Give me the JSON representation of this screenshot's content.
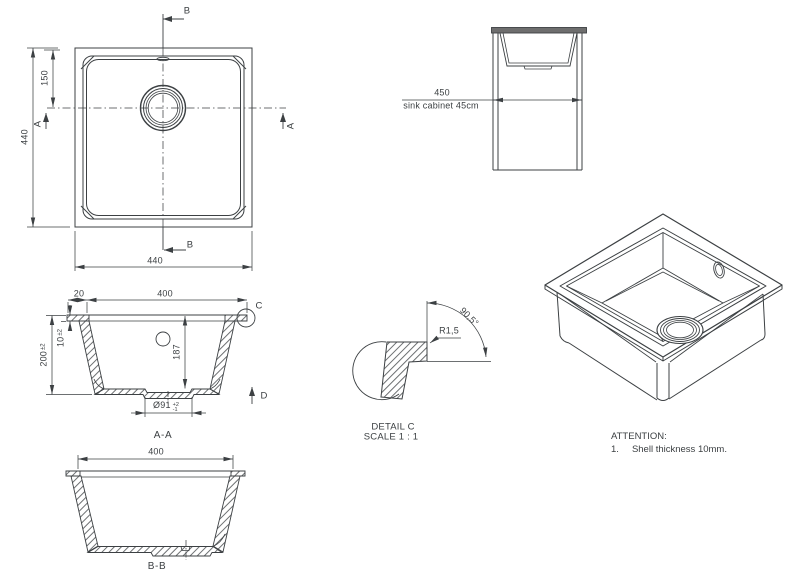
{
  "colors": {
    "line": "#3c4043",
    "text": "#3c4043",
    "countertop_fill": "#6e6e6e",
    "background": "#ffffff"
  },
  "plan_view": {
    "dim_width": "440",
    "dim_height": "440",
    "dim_drain_offset": "150",
    "section_label_a": "A",
    "section_label_b": "B"
  },
  "cabinet_view": {
    "dim_width": "450",
    "caption": "sink cabinet 45cm"
  },
  "section_aa": {
    "dim_flange": "20",
    "dim_inner_width": "400",
    "dim_rim_thickness": {
      "value": "10",
      "tol": "±2"
    },
    "dim_height": {
      "value": "200",
      "tol": "±2"
    },
    "dim_depth": "187",
    "dim_drain": {
      "value": "Ø91",
      "tol_plus": "+2",
      "tol_minus": "-1"
    },
    "detail_label": "C",
    "view_arrow_label": "D",
    "caption": "A-A"
  },
  "detail_c": {
    "dim_radius": "R1,5",
    "dim_angle": "90,5°",
    "caption_title": "DETAIL C",
    "caption_scale": "SCALE 1 : 1"
  },
  "section_bb": {
    "dim_inner_width": "400",
    "caption": "B-B"
  },
  "attention": {
    "title": "ATTENTION:",
    "item_number": "1.",
    "item_text": "Shell thickness 10mm."
  }
}
